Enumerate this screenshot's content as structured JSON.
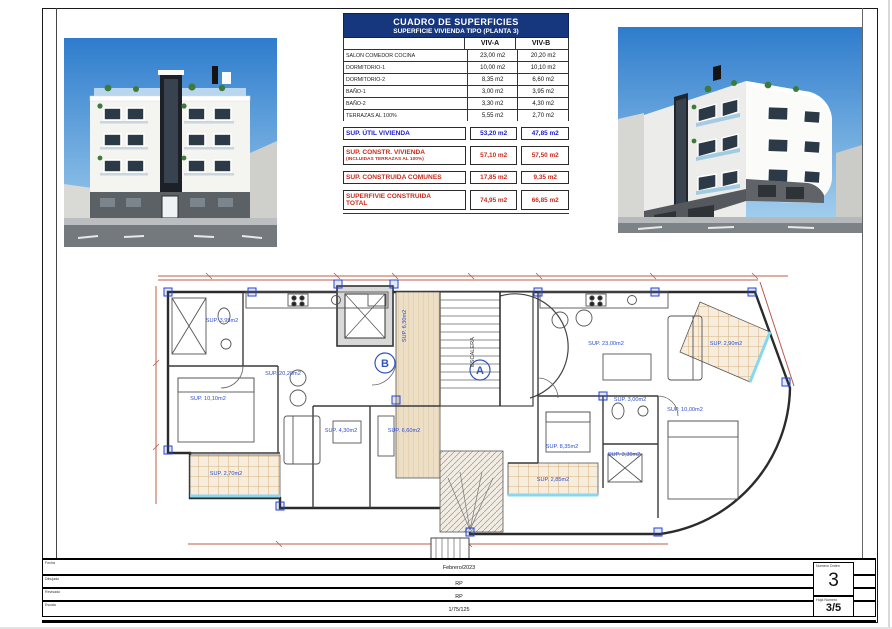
{
  "colors": {
    "header_navy": "#16377e",
    "accent_blue": "#1a1acc",
    "accent_red": "#cc2a1a",
    "plan_label_blue": "#2f4fd0",
    "dimension_red": "#b85c4a",
    "sky_blue": "#3f87d9",
    "tile_beige": "#f3e9d8"
  },
  "table": {
    "title": "CUADRO DE SUPERFICIES",
    "subtitle": "SUPERFICIE VIVIENDA TIPO  (PLANTA 3)",
    "col_a": "VIV-A",
    "col_b": "VIV-B",
    "rows": [
      {
        "label": "SALON COMEDOR COCINA",
        "a": "23,00 m2",
        "b": "20,20 m2"
      },
      {
        "label": "DORMITORIO-1",
        "a": "10,00 m2",
        "b": "10,10 m2"
      },
      {
        "label": "DORMITORIO-2",
        "a": "8,35 m2",
        "b": "6,60 m2"
      },
      {
        "label": "BAÑO-1",
        "a": "3,00 m2",
        "b": "3,95 m2"
      },
      {
        "label": "BAÑO-2",
        "a": "3,30 m2",
        "b": "4,30 m2"
      },
      {
        "label": "TERRAZAS AL 100%",
        "a": "5,55 m2",
        "b": "2,70 m2"
      }
    ],
    "summary": [
      {
        "label": "SUP. ÚTIL VIVIENDA",
        "sub": "",
        "a": "53,20 m2",
        "b": "47,85 m2"
      },
      {
        "label": "SUP. CONSTR. VIVIENDA",
        "sub": "(INCLUIDAS TERRAZAS AL 100%)",
        "a": "57,10 m2",
        "b": "57,50 m2"
      },
      {
        "label": "SUP. CONSTRUIDA COMUNES",
        "sub": "",
        "a": "17,85 m2",
        "b": "9,35 m2"
      },
      {
        "label": "SUPERFIVIE CONSTRUIDA",
        "sub": "TOTAL",
        "a": "74,95 m2",
        "b": "66,85 m2"
      }
    ]
  },
  "plan": {
    "labels": [
      "SUP. 3,95m2",
      "SUP. 20,20m2",
      "SUP. 10,10m2",
      "SUP. 2,70m2",
      "SUP. 4,30m2",
      "SUP. 6,60m2",
      "SUP. 6,30m2",
      "ESCALERA",
      "SUP. 23,00m2",
      "SUP. 2,90m2",
      "SUP. 3,00m2",
      "SUP. 10,00m2",
      "SUP. 8,35m2",
      "SUP. 3,30m2",
      "SUP. 2,85m2"
    ],
    "unit_b": "B",
    "unit_a": "A"
  },
  "titleblock": {
    "expediente_label": "Expediente/Forma",
    "expediente": "RR-342-20",
    "situacion_label": "SITUACION:",
    "situacion_line1": "PROY. B y EJECUCIÓN  EDIFICIO 12 VIVIENDAS",
    "situacion_line2": "EN RESID. MULTIPLE MANZANA CERRADA (RmMc).",
    "peticionario_label": "PETICIONARIO:-",
    "peticionario": "INTERCOSTA VILLAS, S.L. ——",
    "escala_grafica_label": "Escala Grafica",
    "sheet_note": "A3-H2-30X29.7D",
    "title_line1": "PROY. B y EJECUCIÓN  EDIFICIO 12 VIVIENDAS",
    "title_line2": "EN RESID. MÚLTIPLE MANZANA CERRADA (RmMc)",
    "address": "CL UNION MUSICAL TORREVIEJENSES 23, 03183  Torrevieja (ALICANTE).",
    "denominacion_label": "DENOMINACION:",
    "denominacion": "PLANTA 3, COTAS Y SUPERFICIES.",
    "fecha_label": "Fecha",
    "fecha": "Febrero/2023",
    "dibujado_label": "Dibujado",
    "dibujado": "RP",
    "revisado_label": "Revisado",
    "revisado": "RP",
    "escala_label": "Escala",
    "escala": "1/75/125",
    "numero_orden_label": "Numero Orden",
    "numero_orden": "3",
    "hoja_label": "Hoja Numero",
    "hoja": "3/5"
  }
}
